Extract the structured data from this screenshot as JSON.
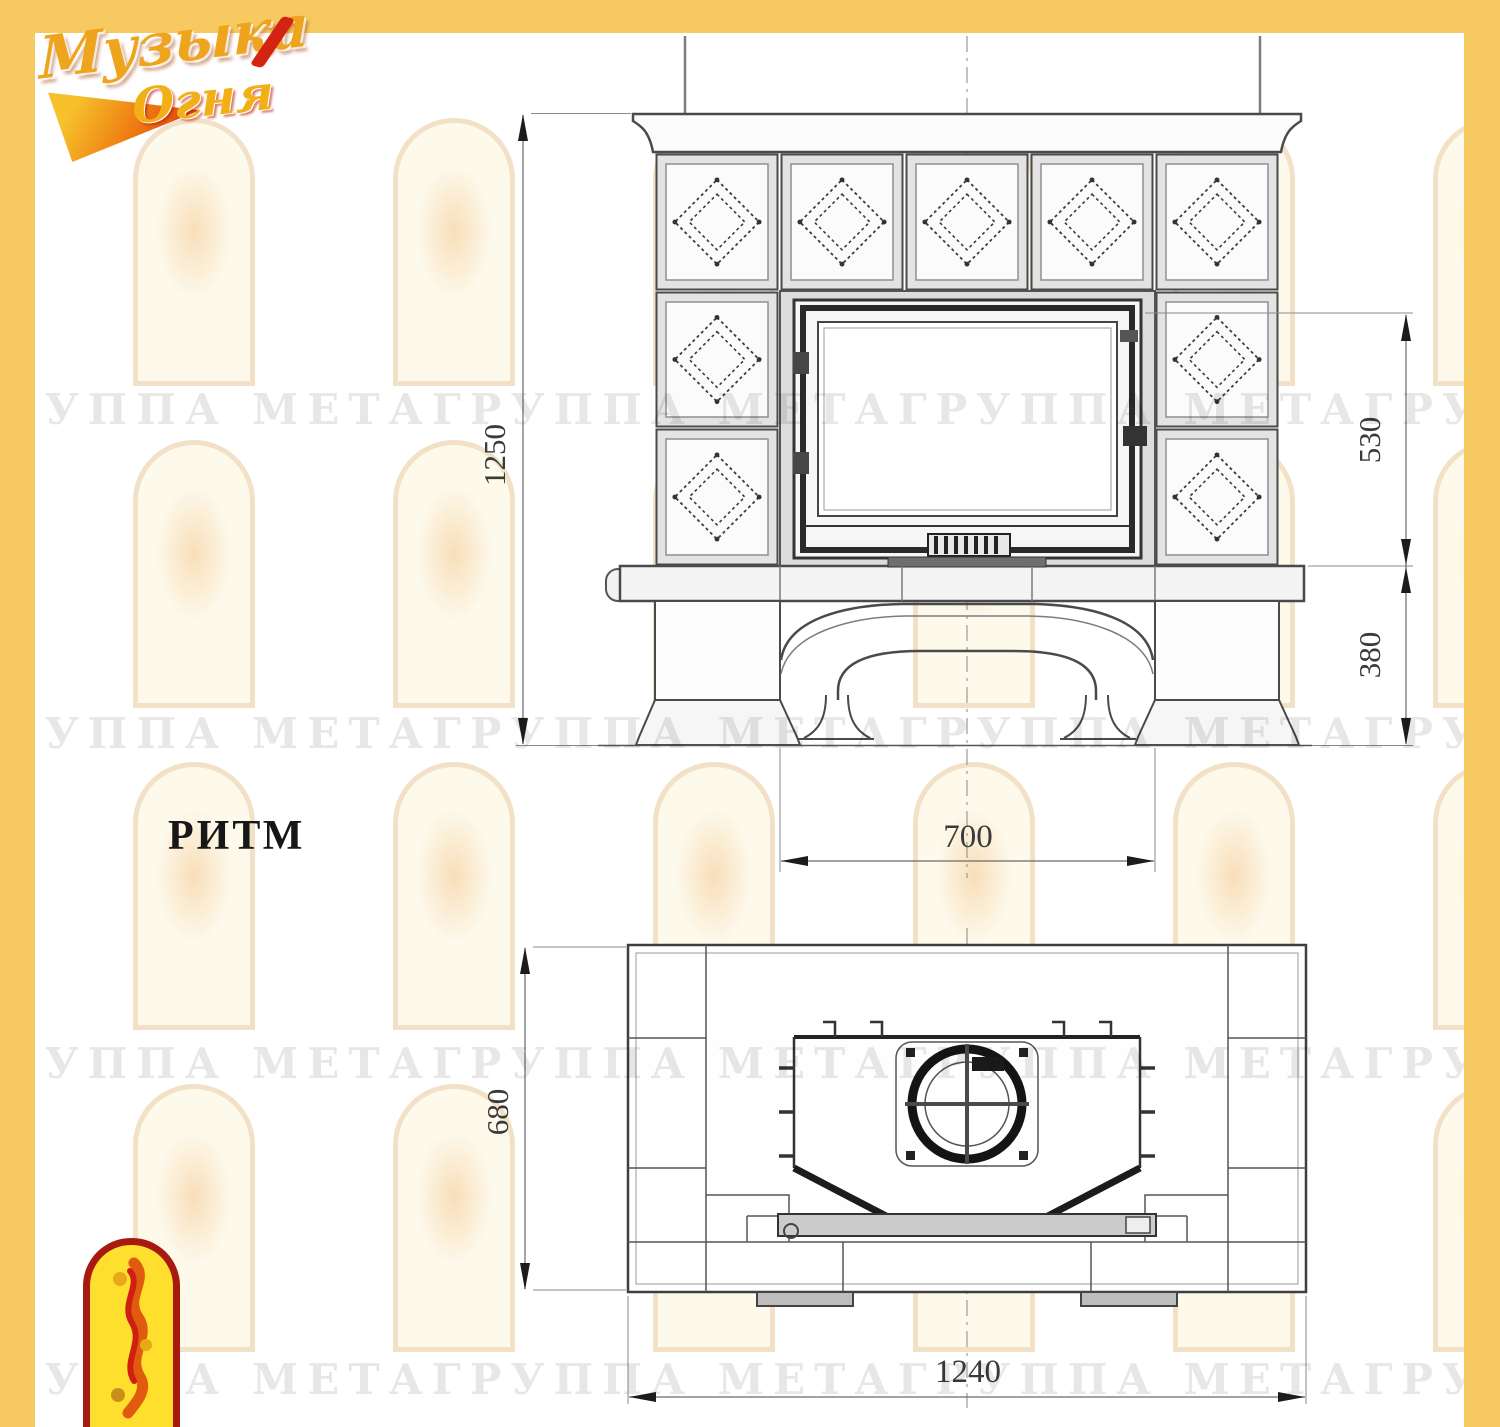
{
  "brand": {
    "name_line1": "Музыка",
    "name_line2": "Огня"
  },
  "watermark": {
    "row_text": "ГРУППА МЕТАГРУППА МЕТАГРУППА МЕТАГРУППА МЕТАГРУППА МЕТА"
  },
  "drawing": {
    "model_name": "РИТМ",
    "front_view": {
      "dim_total_height": "1250",
      "dim_firebox_height": "530",
      "dim_base_height": "380",
      "dim_portal_width": "700"
    },
    "plan_view": {
      "dim_depth": "680",
      "dim_width": "1240"
    }
  }
}
